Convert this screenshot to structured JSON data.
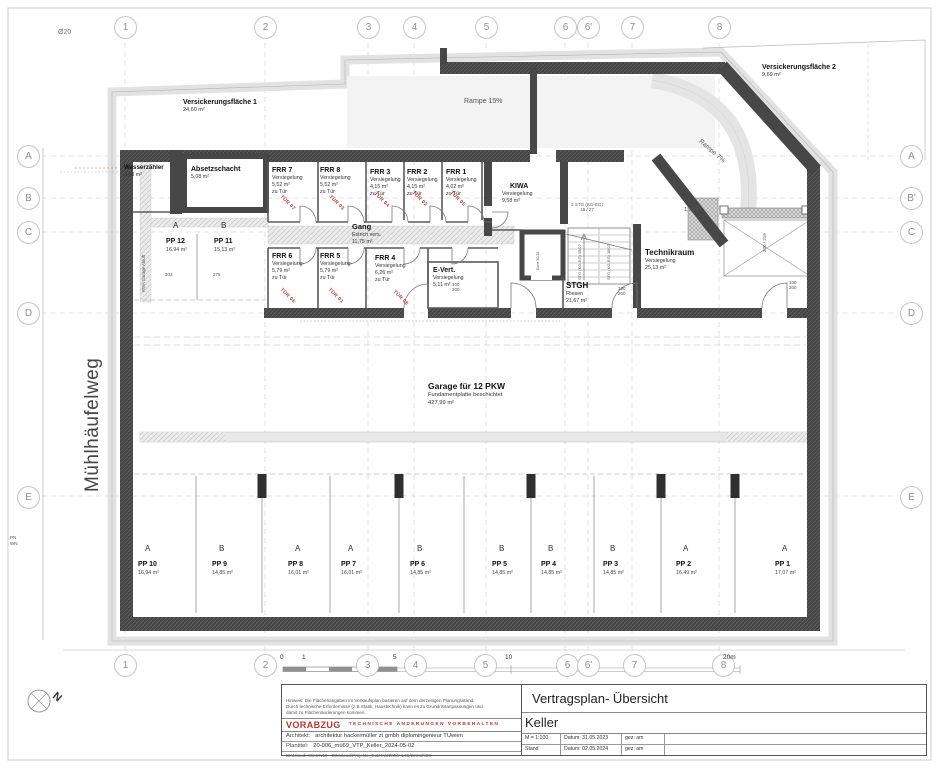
{
  "page": {
    "diameter_note": "Ø20",
    "street": "Mühlhäufelweg",
    "pn": "PN",
    "wn": "WN",
    "north": "N"
  },
  "grid": {
    "cols": [
      "1",
      "2",
      "3",
      "4",
      "5",
      "6",
      "6'",
      "7",
      "8"
    ],
    "rows_left": [
      "A",
      "B",
      "C",
      "D",
      "E"
    ],
    "rows_right": [
      "A",
      "B'",
      "C",
      "D",
      "E"
    ]
  },
  "site": {
    "v1_name": "Versickerungsfläche 1",
    "v1_area": "24,60 m²",
    "v2_name": "Versickerungsfläche 2",
    "v2_area": "9,69 m²",
    "rampe15": "Rampe 15%",
    "rampe7": "Rampe 7%",
    "clearance": "1,70 m",
    "dim_w": "330",
    "dim_h": "219"
  },
  "rooms": {
    "wasserzaehler": {
      "name": "Wasserzähler",
      "area": "3,53 m²"
    },
    "absetzschacht": {
      "name": "Absetzschacht",
      "area": "5,08 m²"
    },
    "frr7": {
      "name": "FRR 7",
      "use": "Versiegelung",
      "area": "5,52 m²",
      "zu": "zu Tür",
      "tuer": "TÜR 07"
    },
    "frr8": {
      "name": "FRR 8",
      "use": "Versiegelung",
      "area": "5,52 m²",
      "zu": "zu Tür",
      "tuer": "TÜR 03"
    },
    "frr3": {
      "name": "FRR 3",
      "use": "Versiegelung",
      "area": "4,15 m²",
      "zu": "zu Tür",
      "tuer": "TÜR 04"
    },
    "frr2": {
      "name": "FRR 2",
      "use": "Versiegelung",
      "area": "4,15 m²",
      "zu": "zu Tür",
      "tuer": "TÜR 02"
    },
    "frr1": {
      "name": "FRR 1",
      "use": "Versiegelung",
      "area": "4,02 m²",
      "zu": "zu Tür",
      "tuer": "TÜR 05"
    },
    "kiwa": {
      "name": "KIWA",
      "use": "Versiegelung",
      "area": "9,58 m²"
    },
    "frr6": {
      "name": "FRR 6",
      "use": "Versiegelung",
      "area": "5,79 m²",
      "zu": "zu Tür",
      "tuer": "TÜR 06"
    },
    "frr5": {
      "name": "FRR 5",
      "use": "Versiegelung",
      "area": "5,79 m²",
      "zu": "zu Tür",
      "tuer": "TÜR 01"
    },
    "frr4": {
      "name": "FRR 4",
      "use": "Versiegelung",
      "area": "6,26 m²",
      "zu": "zu Tür",
      "tuer": "TÜR 08"
    },
    "evert": {
      "name": "E-Vert.",
      "use": "Versiegelung",
      "area": "5,11 m²"
    },
    "gang": {
      "name": "Gang",
      "use": "Estrich vers.",
      "area": "11,75 m²"
    },
    "stgh": {
      "name": "STGH",
      "use": "Fliesen",
      "area": "21,67 m²"
    },
    "technikraum": {
      "name": "Technikraum",
      "use": "Versiegelung",
      "area": "25,13 m²"
    },
    "garage": {
      "name": "Garage für 12 PKW",
      "use": "Fundamentplatte beschichtet",
      "area": "427,99 m²"
    }
  },
  "annotations": {
    "stairs1": "2 STG (KG-EG)",
    "stairs2": "18 / 27",
    "flight": "STG (KG-EG) 18/27",
    "rwa": "RWA Garage Abluft",
    "lift": "Kone 50/15",
    "door1": "100",
    "door2": "200",
    "dim303": "303",
    "dim275": "275"
  },
  "parking_upper": [
    {
      "t": "A",
      "name": "PP 12",
      "area": "16,94 m²"
    },
    {
      "t": "B",
      "name": "PP 11",
      "area": "15,13 m²"
    }
  ],
  "parking": [
    {
      "t": "A",
      "name": "PP 10",
      "area": "16,94 m²"
    },
    {
      "t": "B",
      "name": "PP 9",
      "area": "14,85 m²"
    },
    {
      "t": "A",
      "name": "PP 8",
      "area": "16,01 m²"
    },
    {
      "t": "A",
      "name": "PP 7",
      "area": "16,01 m²"
    },
    {
      "t": "B",
      "name": "PP 6",
      "area": "14,85 m²"
    },
    {
      "t": "B",
      "name": "PP 5",
      "area": "14,85 m²"
    },
    {
      "t": "B",
      "name": "PP 4",
      "area": "14,85 m²"
    },
    {
      "t": "B",
      "name": "PP 3",
      "area": "14,85 m²"
    },
    {
      "t": "A",
      "name": "PP 2",
      "area": "16,49 m²"
    },
    {
      "t": "A",
      "name": "PP 1",
      "area": "17,07 m²"
    }
  ],
  "scalebar": {
    "s0": "0",
    "s1": "1",
    "s5": "5",
    "s10": "10",
    "s20": "20m"
  },
  "titleblock": {
    "hinweis1": "Hinweis: Die Flächenangaben im Verkaufsplan basieren auf dem derzeitigen Planungsstand.",
    "hinweis2": "Durch technische Erfordernisse (z.B.Statik, Haustechnik) kann es zu Grundrissanpassungen und",
    "hinweis3": "damit zu Flächenänderungen kommen.",
    "vorabzug": "VORABZUG",
    "vorbehalt": "TECHNISCHE ÄNDERUNGEN VORBEHALTEN",
    "architekt_label": "Architekt:",
    "architekt": "architektur hackermüller zt gmbh diplomingenieur TUwien",
    "plantitel_label": "Plantitel:",
    "plantitel": "20-006_mü69_VTP_Keller_2024-05-02",
    "bimcloud": "BIMcloud: WinSrv19 - BIMcloud/Projekte_Extern/22MÜHL69/22mühl69",
    "title": "Vertragsplan- Übersicht",
    "subtitle": "Keller",
    "scale": "M = 1:100",
    "datum1": "Datum: 31.05.2023",
    "gez1": "gez: am",
    "stand": "Stand",
    "datum2": "Datum: 02.05.2024",
    "gez2": "gez: am"
  },
  "colors": {
    "wall": "#474747",
    "red": "#b03a2e",
    "site_band": "#e2e2e2"
  }
}
